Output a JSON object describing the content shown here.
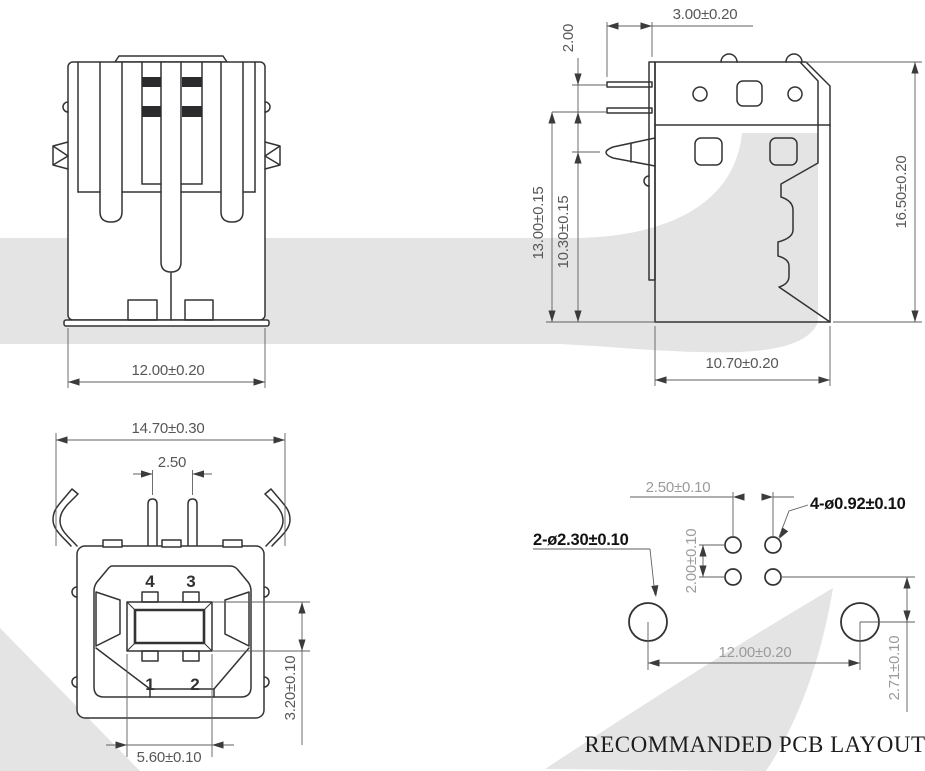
{
  "drawing": {
    "type": "connector mechanical drawing",
    "views": {
      "rear": {
        "name": "rear view",
        "dims": {
          "width": "12.00±0.20"
        }
      },
      "side": {
        "name": "side view",
        "dims": {
          "pin_length": "3.00±0.20",
          "pin_pitch": "2.00",
          "pin_to_base": "13.00±0.15",
          "peg_to_base": "10.30±0.15",
          "overall_height": "16.50±0.20",
          "body_depth": "10.70±0.20"
        }
      },
      "front": {
        "name": "front view",
        "pin_labels": {
          "p4": "4",
          "p3": "3",
          "p1": "1",
          "p2": "2"
        },
        "dims": {
          "overall_width": "14.70±0.30",
          "pin_spacing": "2.50",
          "tongue_height": "3.20±0.10",
          "tongue_width": "5.60±0.10"
        }
      },
      "pcb": {
        "name": "recommended pcb layout",
        "caption": "RECOMMANDED PCB LAYOUT",
        "dims": {
          "signal_hole_pitch_x": "2.50±0.10",
          "signal_hole_pitch_y": "2.00±0.10",
          "signal_holes": "4-ø0.92±0.10",
          "mount_holes": "2-ø2.30±0.10",
          "mount_hole_pitch": "12.00±0.20",
          "row_offset": "2.71±0.10"
        }
      }
    },
    "colors": {
      "outline": "#333335",
      "dim_line": "#5f5f61",
      "dim_text": "#57575a",
      "gray_text": "#9b9b9b",
      "black_label": "#121212",
      "watermark": "#e4e4e4",
      "background": "#ffffff"
    }
  }
}
